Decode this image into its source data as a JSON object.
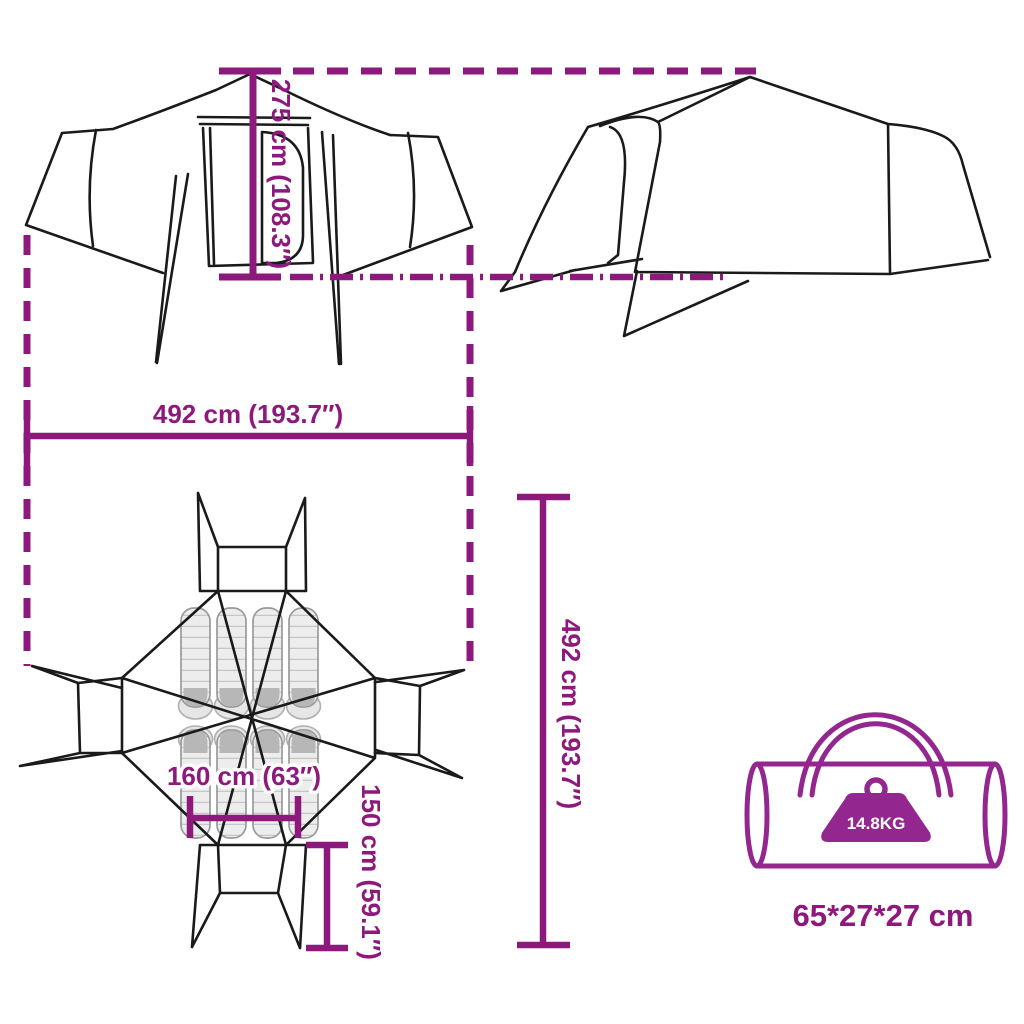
{
  "dimensions": {
    "height": "275 cm (108.3″)",
    "width": "492 cm (193.7″)",
    "depth": "492 cm (193.7″)",
    "inner_width": "160 cm (63″)",
    "inner_height": "150 cm (59.1″)"
  },
  "package": {
    "weight": "14.8KG",
    "size": "65*27*27 cm"
  },
  "colors": {
    "accent": "#8E197D",
    "bag_accent": "#93278F",
    "outline": "#1A1A1A",
    "sleeping_bag_light": "#EDEDED",
    "sleeping_bag_dark": "#B7B7B7"
  }
}
